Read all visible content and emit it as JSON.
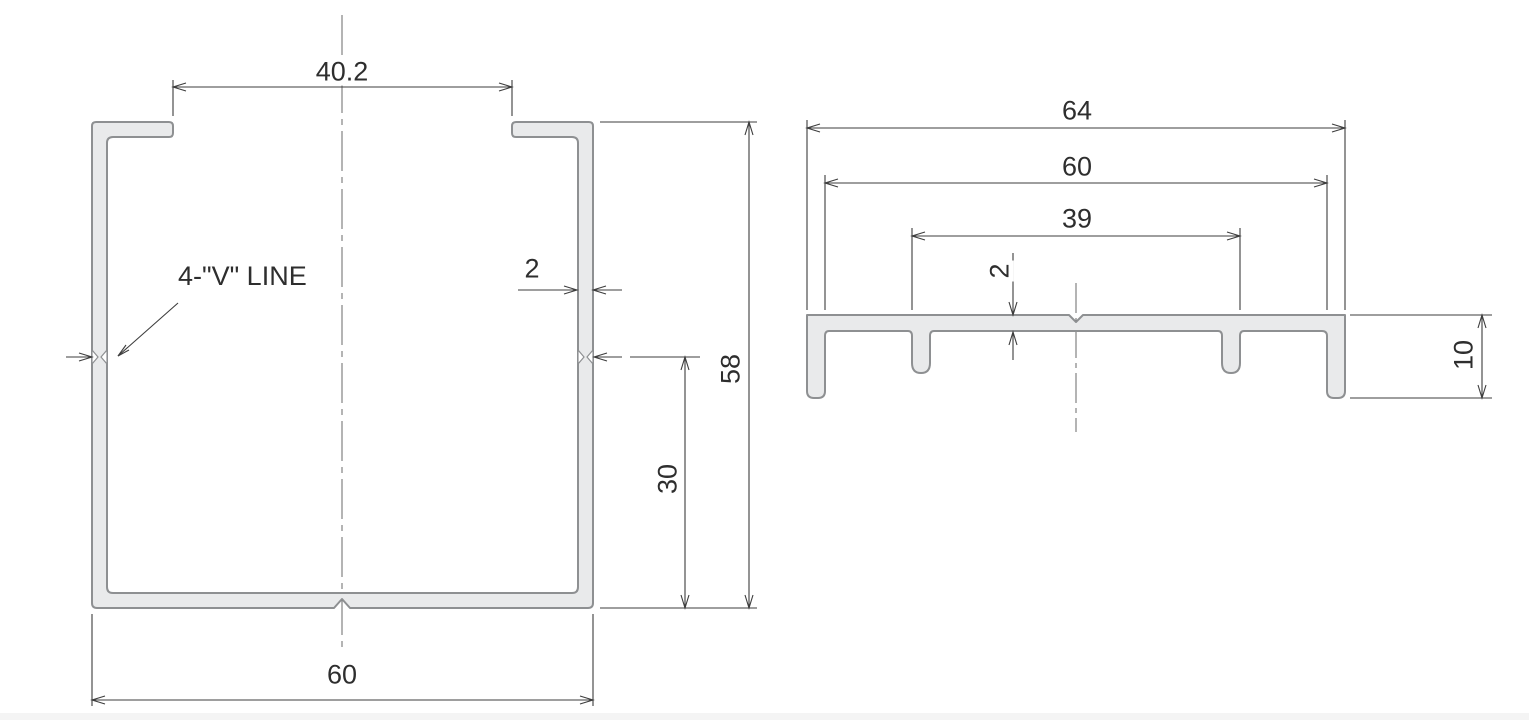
{
  "drawing": {
    "colors": {
      "profile_fill": "#e9eaeb",
      "profile_outline": "#8e9092",
      "dimension_lines": "#3d3d3d",
      "text": "#2e2e2e",
      "background": "#ffffff"
    },
    "front_view": {
      "note_label": "4-\"V\" LINE",
      "dim_opening": "40.2",
      "dim_wall_thickness": "2",
      "dim_overall_height": "58",
      "dim_mark_height": "30",
      "dim_overall_width": "60"
    },
    "side_view": {
      "dim_overall_width": "64",
      "dim_inner_width": "60",
      "dim_rib_span": "39",
      "dim_plate_thickness": "2",
      "dim_leg_height": "10"
    }
  }
}
